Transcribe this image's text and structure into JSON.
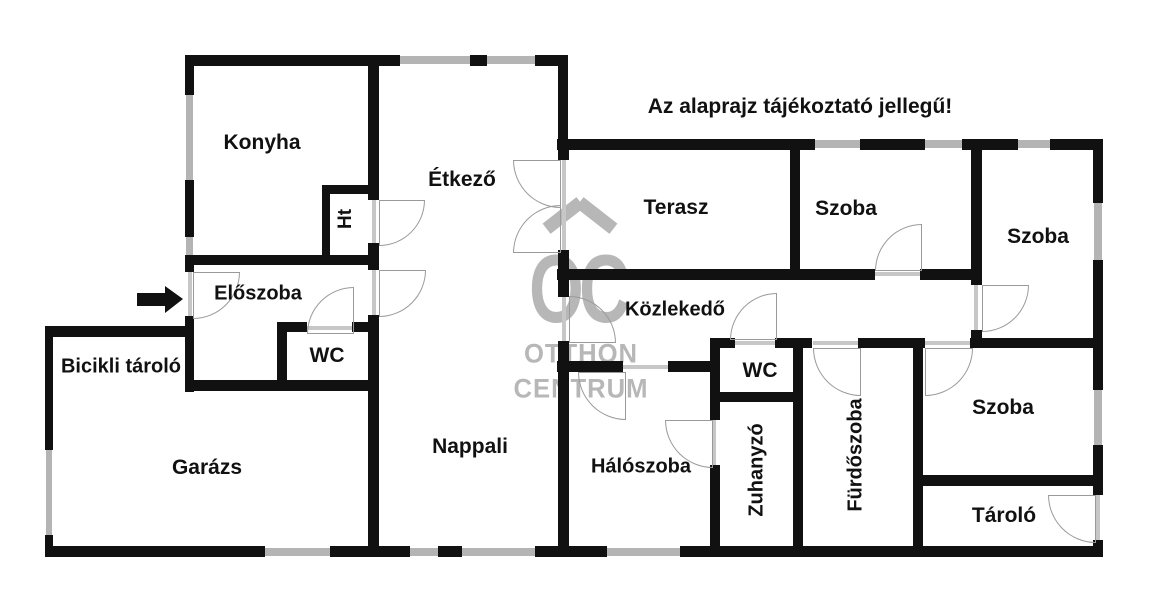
{
  "disclaimer": "Az alaprajz tájékoztató jellegű!",
  "watermark": {
    "logo": "OC",
    "line1": "OTTHON",
    "line2": "CENTRUM"
  },
  "colors": {
    "wall": "#111111",
    "window": "#b4b4b4",
    "door_arc": "#9a9a9a",
    "watermark": "#b7b7b7",
    "text": "#111111",
    "background": "#ffffff"
  },
  "rooms": [
    {
      "id": "konyha",
      "label": "Konyha",
      "x": 262,
      "y": 143,
      "size": 21,
      "rotate": false
    },
    {
      "id": "ht",
      "label": "Ht",
      "x": 346,
      "y": 219,
      "size": 19,
      "rotate": true
    },
    {
      "id": "etkezo",
      "label": "Étkező",
      "x": 462,
      "y": 180,
      "size": 21,
      "rotate": false
    },
    {
      "id": "eloszoba",
      "label": "Előszoba",
      "x": 258,
      "y": 294,
      "size": 20,
      "rotate": false
    },
    {
      "id": "wc-1",
      "label": "WC",
      "x": 327,
      "y": 356,
      "size": 21,
      "rotate": false
    },
    {
      "id": "bicikli-tarolo",
      "label": "Bicikli tároló",
      "x": 121,
      "y": 367,
      "size": 20,
      "rotate": false
    },
    {
      "id": "garazs",
      "label": "Garázs",
      "x": 207,
      "y": 468,
      "size": 21,
      "rotate": false
    },
    {
      "id": "nappali",
      "label": "Nappali",
      "x": 470,
      "y": 447,
      "size": 21,
      "rotate": false
    },
    {
      "id": "terasz",
      "label": "Terasz",
      "x": 676,
      "y": 208,
      "size": 21,
      "rotate": false
    },
    {
      "id": "szoba-1",
      "label": "Szoba",
      "x": 846,
      "y": 209,
      "size": 21,
      "rotate": false
    },
    {
      "id": "szoba-2",
      "label": "Szoba",
      "x": 1038,
      "y": 237,
      "size": 21,
      "rotate": false
    },
    {
      "id": "kozlekedo",
      "label": "Közlekedő",
      "x": 675,
      "y": 310,
      "size": 20,
      "rotate": false
    },
    {
      "id": "wc-2",
      "label": "WC",
      "x": 760,
      "y": 371,
      "size": 21,
      "rotate": false
    },
    {
      "id": "haloszoba",
      "label": "Hálószoba",
      "x": 641,
      "y": 467,
      "size": 20,
      "rotate": false
    },
    {
      "id": "zuhanyzo",
      "label": "Zuhanyzó",
      "x": 757,
      "y": 470,
      "size": 20,
      "rotate": true
    },
    {
      "id": "furdoszoba",
      "label": "Fürdőszoba",
      "x": 856,
      "y": 455,
      "size": 20,
      "rotate": true
    },
    {
      "id": "szoba-3",
      "label": "Szoba",
      "x": 1003,
      "y": 408,
      "size": 21,
      "rotate": false
    },
    {
      "id": "tarolo",
      "label": "Tároló",
      "x": 1004,
      "y": 516,
      "size": 21,
      "rotate": false
    }
  ]
}
